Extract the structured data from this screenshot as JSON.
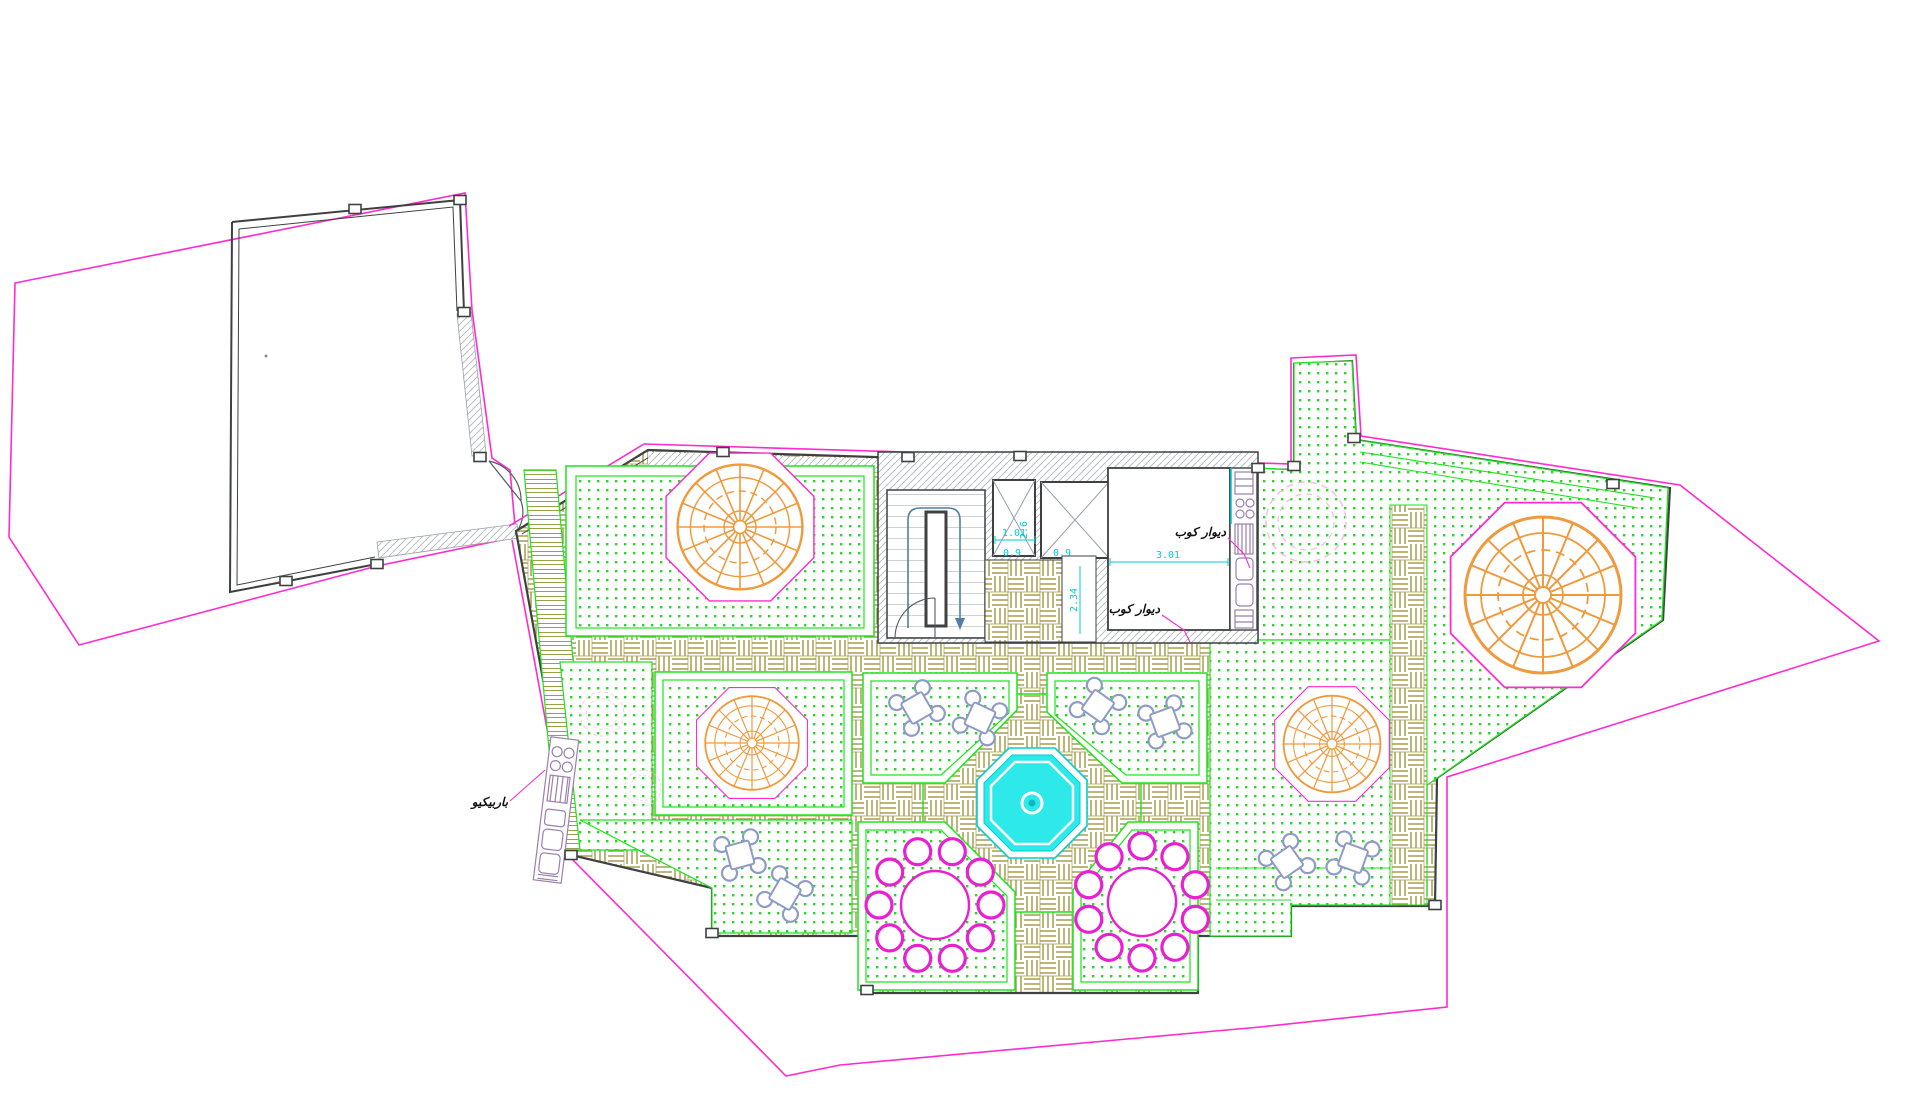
{
  "drawing": {
    "type": "architectural-roof-garden-plan",
    "annotations": {
      "barbecue_label": "باربیکیو",
      "wall_mount_label_a": "دیوار کوب",
      "wall_mount_label_b": "دیوار کوب"
    },
    "dimensions": {
      "elevator_shaft_depth": "2.6",
      "elevator_shaft_width": "1.01",
      "elevator_door_left": "0.9",
      "elevator_door_right": "0.9",
      "corridor_width": "2.34",
      "kitchen_room_width": "3.01"
    },
    "palette": {
      "property_line": "#ff2bd0",
      "wall_line": "#3f4040",
      "hatch_gray": "#b9bec4",
      "grass_dot_green": "#2fd32f",
      "terrace_border_green": "#1ae51a",
      "parquet_olive": "#a59d4e",
      "pergola_orange": "#f09a3e",
      "pool_cyan": "#2ee9e9",
      "dimension_cyan": "#00cdd8",
      "furniture_blue": "#8e9cc4",
      "furniture_magenta": "#ea1fd3",
      "stair_path_blue": "#4f7fa6",
      "appliance_purple": "#9b7fae"
    },
    "features": {
      "pergolas": 4,
      "square_tables_4_seats": 8,
      "round_tables_10_seats": 2,
      "elevator_shafts": 2,
      "stair_cores": 1,
      "central_pool": 1,
      "tree_symbols": 3,
      "barbecue_counters": 1,
      "kitchen_counters": 1
    }
  }
}
